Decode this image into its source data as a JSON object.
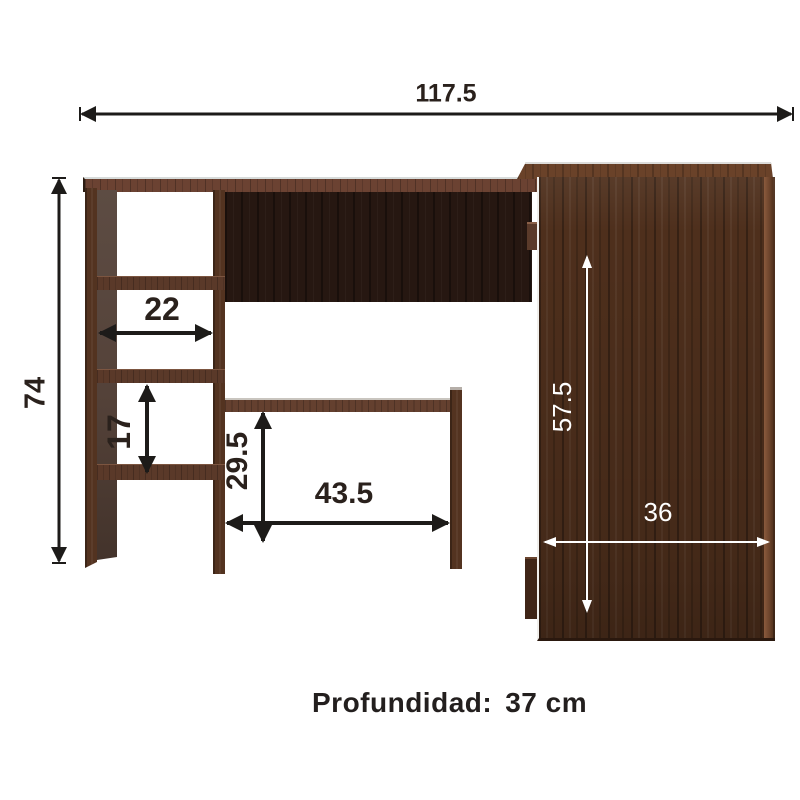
{
  "dims": {
    "total_width": "117.5",
    "total_height": "74",
    "shelf_width": "22",
    "shelf_gap_height": "17",
    "tray_clearance_height": "29.5",
    "tray_width": "43.5",
    "cabinet_height": "57.5",
    "cabinet_width": "36"
  },
  "footer": {
    "depth_label": "Profundidad:",
    "depth_value": "37 cm"
  },
  "colors": {
    "background": "#ffffff",
    "dimension_dark": "#1d1b19",
    "dimension_light": "#ffffff",
    "caption_text": "#231f1e",
    "wood_medium": "#533320",
    "wood_top_edge": "#6b4232",
    "wood_back_panel": "#261711",
    "cabinet_front": "#4e2f1c"
  }
}
